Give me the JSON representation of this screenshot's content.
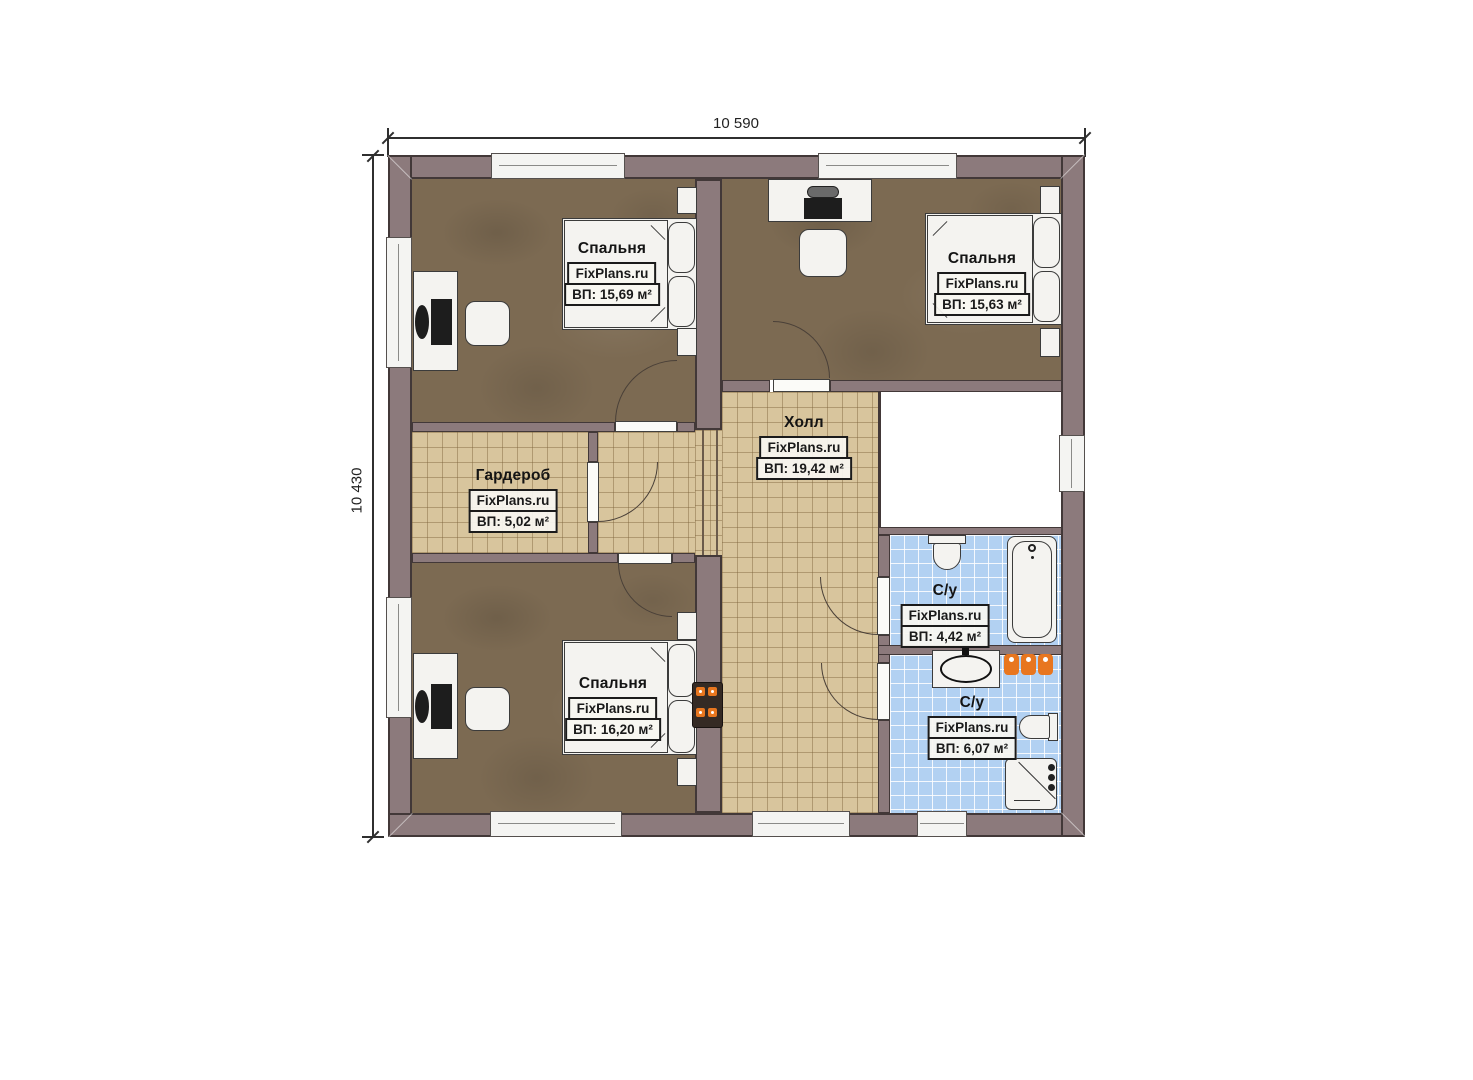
{
  "plan": {
    "dimensions": {
      "width_label": "10 590",
      "height_label": "10 430"
    },
    "rooms": [
      {
        "key": "bedroom-top-left",
        "name": "Спальня",
        "watermark": "FixPlans.ru",
        "area": "ВП: 15,69 м²"
      },
      {
        "key": "bedroom-top-right",
        "name": "Спальня",
        "watermark": "FixPlans.ru",
        "area": "ВП: 15,63 м²"
      },
      {
        "key": "wardrobe",
        "name": "Гардероб",
        "watermark": "FixPlans.ru",
        "area": "ВП: 5,02 м²"
      },
      {
        "key": "hall",
        "name": "Холл",
        "watermark": "FixPlans.ru",
        "area": "ВП: 19,42 м²"
      },
      {
        "key": "bathroom-top",
        "name": "С/у",
        "watermark": "FixPlans.ru",
        "area": "ВП: 4,42 м²"
      },
      {
        "key": "bathroom-bottom",
        "name": "С/у",
        "watermark": "FixPlans.ru",
        "area": "ВП: 6,07 м²"
      },
      {
        "key": "bedroom-bottom-left",
        "name": "Спальня",
        "watermark": "FixPlans.ru",
        "area": "ВП: 16,20 м²"
      }
    ],
    "colors": {
      "wall": "#8c7a7c",
      "carpet": "#7c6a52",
      "tile": "#d8c59d",
      "bath_tile": "#b2d1f2",
      "accent_orange": "#e8761f"
    }
  }
}
